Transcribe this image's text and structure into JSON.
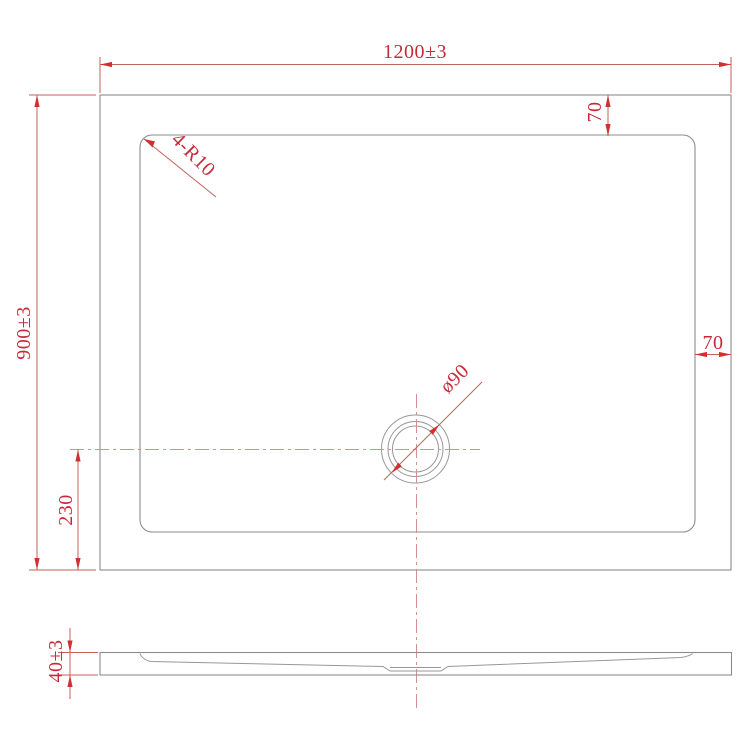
{
  "drawing": {
    "labels": {
      "overall_width": "1200±3",
      "overall_depth": "900±3",
      "top_margin": "70",
      "right_margin": "70",
      "drain_offset": "230",
      "tray_thickness": "40±3",
      "corner_radius": "4-R10",
      "drain_diameter": "ø90"
    },
    "colors": {
      "dimension_line": "#c2625b",
      "dimension_text": "#c9293a",
      "arrow": "#d03030",
      "geometry": "#8c8c8c",
      "centerline": "#d49090",
      "background": "#ffffff"
    }
  }
}
